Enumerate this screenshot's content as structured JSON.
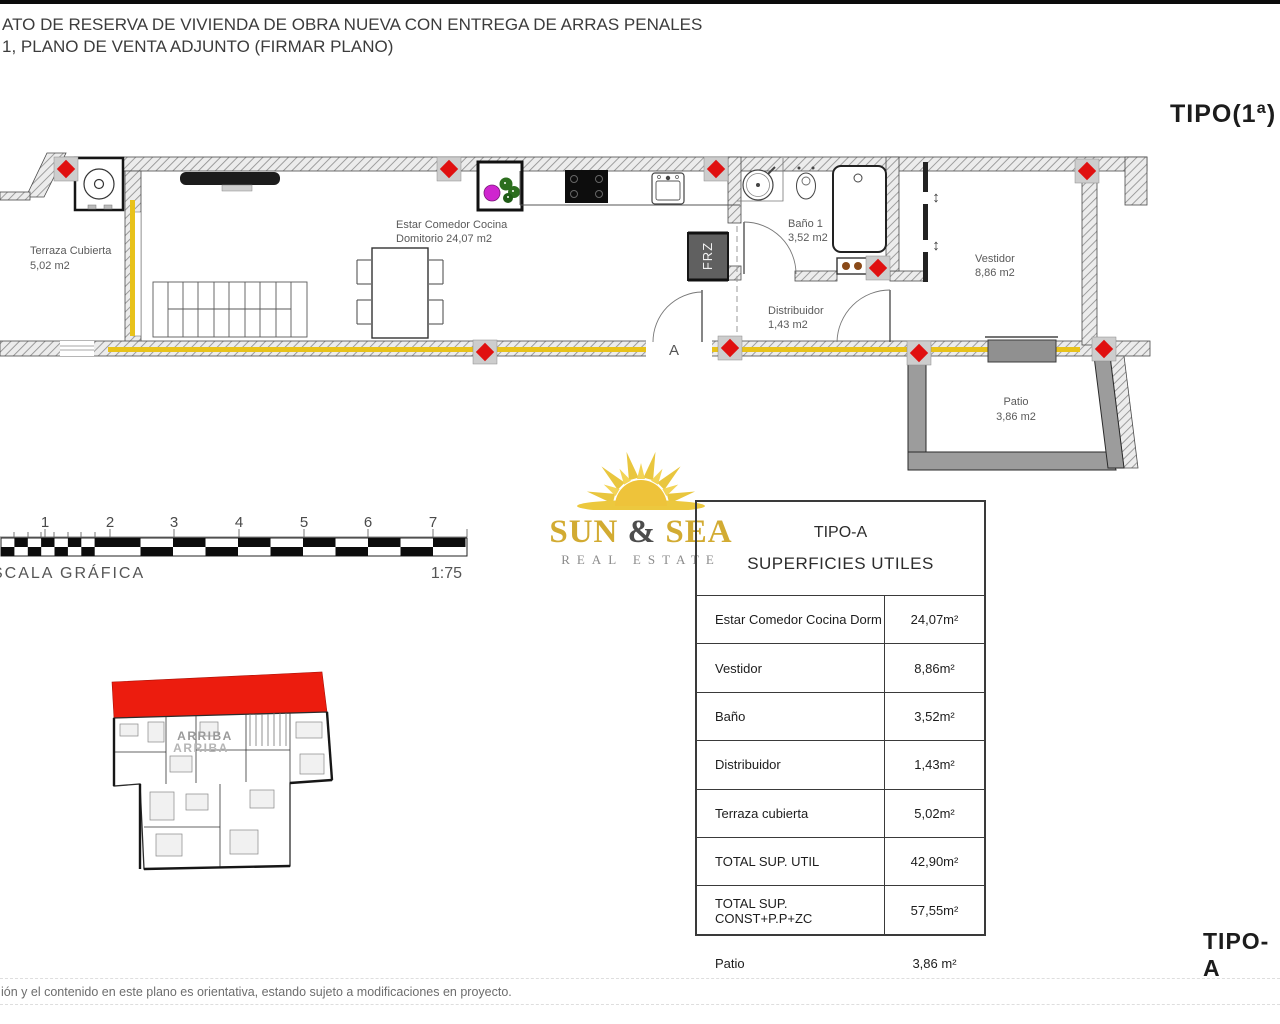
{
  "header": {
    "line1": "ATO DE RESERVA DE VIVIENDA DE OBRA NUEVA CON ENTREGA DE ARRAS PENALES",
    "line2": "1, PLANO DE VENTA ADJUNTO (FIRMAR PLANO)"
  },
  "labels": {
    "tipo_top": "TIPO(1ª)",
    "tipo_bottom": "TIPO-A"
  },
  "floorplan": {
    "rooms": {
      "terraza": {
        "name": "Terraza Cubierta",
        "area": "5,02 m2"
      },
      "estar": {
        "name": "Estar Comedor Cocina",
        "area": "Domitorio 24,07 m2"
      },
      "bano": {
        "name": "Baño 1",
        "area": "3,52 m2"
      },
      "distribuidor": {
        "name": "Distribuidor",
        "area": "1,43 m2"
      },
      "vestidor": {
        "name": "Vestidor",
        "area": "8,86 m2"
      },
      "patio": {
        "name": "Patio",
        "area": "3,86 m2"
      }
    },
    "tags": {
      "fridge": "FRZ",
      "entrance_door": "A",
      "wardrobe_arrow": "↕"
    },
    "overview_label": "ARRIBA"
  },
  "scalebar": {
    "ticks": [
      "1",
      "2",
      "3",
      "4",
      "5",
      "6",
      "7"
    ],
    "caption": "SCALA GRÁFICA",
    "ratio": "1:75"
  },
  "logo": {
    "word1": "SUN",
    "amp": "&",
    "word2": "SEA",
    "tagline": "REAL ESTATE"
  },
  "table": {
    "title": "TIPO-A",
    "subtitle": "SUPERFICIES UTILES",
    "rows": [
      {
        "label": "Estar Comedor Cocina Dorm",
        "value": "24,07m²"
      },
      {
        "label": "Vestidor",
        "value": "8,86m²"
      },
      {
        "label": "Baño",
        "value": "3,52m²"
      },
      {
        "label": "Distribuidor",
        "value": "1,43m²"
      },
      {
        "label": "Terraza cubierta",
        "value": "5,02m²"
      },
      {
        "label": "TOTAL SUP. UTIL",
        "value": "42,90m²"
      },
      {
        "label": "TOTAL SUP. CONST+P.P+ZC",
        "value": "57,55m²"
      }
    ],
    "outside_row": {
      "label": "Patio",
      "value": "3,86 m²"
    }
  },
  "disclaimer": "ión y el contenido en este plano es orientativa, estando sujeto a modificaciones en proyecto.",
  "colors": {
    "accent_red": "#e01010",
    "insulation_yellow": "#e8c21a",
    "logo_gold": "#d2ab32",
    "highlight_red": "#ec1c0e"
  }
}
